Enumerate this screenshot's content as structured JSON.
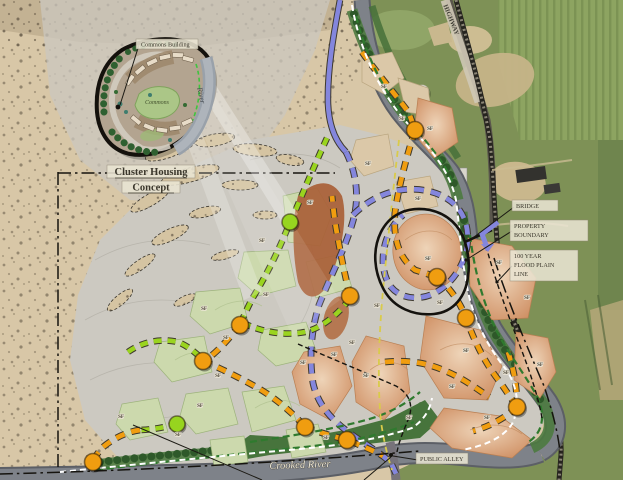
{
  "map": {
    "labels": {
      "highway": "HIGHWAY",
      "crooked_river": "Crooked River",
      "bridge": "BRIDGE",
      "property_boundary_1": "PROPERTY",
      "property_boundary_2": "BOUNDARY",
      "flood_plain_1": "100 YEAR",
      "flood_plain_2": "FLOOD PLAIN",
      "flood_plain_3": "LINE",
      "public_alley": "PUBLIC ALLEY",
      "lot": "SF"
    },
    "inset": {
      "title_line1": "Cluster Housing",
      "title_line2": "Concept",
      "commons_building": "Commons Building",
      "commons": "Commons",
      "river": "River"
    },
    "colors": {
      "orange_node": "#f09d10",
      "lime_node": "#97d41f",
      "purple_road": "#8486dd",
      "orange_road": "#f09d10",
      "lime_road": "#9ad41f",
      "green_trail": "#2f7a2e",
      "yellow_line": "#d9cb4a",
      "river_water": "#7e8289",
      "riparian_green": "#4d7a40",
      "desert_tan": "#d8c7a7",
      "floodplain_gray": "#ccc9c1",
      "lot_green": "#ccd9ad",
      "lot_salmon": "#d89a6f",
      "aerial_field_green": "#7e9156"
    },
    "nodes": {
      "orange": [
        [
          415,
          130
        ],
        [
          350,
          296
        ],
        [
          240,
          325
        ],
        [
          203,
          361
        ],
        [
          93,
          462
        ],
        [
          305,
          427
        ],
        [
          347,
          440
        ],
        [
          437,
          277
        ],
        [
          466,
          318
        ],
        [
          517,
          407
        ]
      ],
      "lime": [
        [
          290,
          222
        ],
        [
          177,
          424
        ]
      ]
    },
    "sf_positions": [
      [
        402,
        120
      ],
      [
        368,
        165
      ],
      [
        418,
        200
      ],
      [
        310,
        204
      ],
      [
        262,
        242
      ],
      [
        266,
        296
      ],
      [
        204,
        310
      ],
      [
        226,
        339
      ],
      [
        218,
        377
      ],
      [
        200,
        407
      ],
      [
        121,
        418
      ],
      [
        178,
        436
      ],
      [
        428,
        260
      ],
      [
        377,
        307
      ],
      [
        440,
        304
      ],
      [
        352,
        344
      ],
      [
        334,
        356
      ],
      [
        303,
        364
      ],
      [
        366,
        377
      ],
      [
        409,
        419
      ],
      [
        326,
        439
      ],
      [
        506,
        374
      ],
      [
        540,
        366
      ],
      [
        499,
        264
      ],
      [
        527,
        299
      ],
      [
        466,
        352
      ],
      [
        487,
        419
      ],
      [
        452,
        388
      ],
      [
        384,
        88
      ],
      [
        430,
        130
      ]
    ],
    "roads": [
      {
        "name": "riparian-band-upper-west",
        "kind": "greenband",
        "d": "M352,10 C366,56 386,94 412,124 C436,150 452,172 458,200"
      },
      {
        "name": "riparian-band-east",
        "kind": "greenband",
        "d": "M462,212 C466,252 474,292 490,326 C506,356 528,380 544,404 C554,424 550,440 532,448"
      },
      {
        "name": "riparian-band-bottom",
        "kind": "greenband",
        "d": "M95,465 C170,456 240,450 300,445 C345,441 385,432 418,416"
      },
      {
        "name": "riparian-band-upper-east",
        "kind": "greenband2",
        "d": "M372,6 C384,46 400,82 424,112 C438,130 450,144 458,158"
      },
      {
        "name": "tree-row-upper",
        "kind": "treerow",
        "d": "M354,14 C368,58 388,95 414,126 C436,150 450,168 456,190"
      },
      {
        "name": "tree-row-east",
        "kind": "treerow",
        "d": "M464,220 C468,256 476,294 492,328 C508,358 528,380 542,402"
      },
      {
        "name": "tree-row-bottom",
        "kind": "treerow",
        "d": "M100,462 C170,454 240,448 298,443 C342,439 382,430 414,414"
      },
      {
        "name": "tree-row-bottom-2",
        "kind": "treerow",
        "d": "M232,458 C270,448 310,442 352,434 C380,428 404,420 424,404"
      },
      {
        "name": "collector-road-north",
        "kind": "purple-solid",
        "casing": true,
        "d": "M340,0 C334,32 327,70 328,104 C329,126 336,142 346,152"
      },
      {
        "name": "collector-road-main",
        "kind": "purple",
        "casing": true,
        "d": "M346,152 C356,172 360,196 353,221 C345,249 330,277 319,305 C311,331 309,357 313,383 C318,406 333,421 351,434 C366,445 381,453 391,463 L397,476"
      },
      {
        "name": "collector-road-loop",
        "kind": "purple",
        "casing": true,
        "d": "M353,215 C365,203 381,193 401,190 C423,187 445,193 458,208 C467,220 469,233 467,247 C464,265 453,283 435,293 C419,301 401,299 391,287 C382,275 381,257 386,241 C390,229 396,221 403,215"
      },
      {
        "name": "local-road-north",
        "kind": "orange",
        "casing": true,
        "d": "M362,52 C376,72 396,95 409,113 L415,130 C405,162 399,186 395,212 C393,240 399,258 415,270 L437,277"
      },
      {
        "name": "local-road-east",
        "kind": "orange",
        "casing": true,
        "d": "M437,277 C450,288 460,302 466,318 C474,340 484,362 500,382 L517,407"
      },
      {
        "name": "local-road-east-spur",
        "kind": "orange",
        "casing": true,
        "d": "M517,407 C504,419 488,427 473,431"
      },
      {
        "name": "local-road-east-north-spur",
        "kind": "orange",
        "casing": true,
        "d": "M508,352 C514,370 517,388 517,405"
      },
      {
        "name": "local-road-center-north",
        "kind": "orange",
        "casing": true,
        "d": "M350,296 C344,272 340,250 336,228 C334,216 333,206 332,196"
      },
      {
        "name": "local-road-cross",
        "kind": "orange",
        "casing": true,
        "d": "M385,362 C405,360 425,362 443,370 C461,377 476,388 489,397"
      },
      {
        "name": "local-road-southwest",
        "kind": "orange",
        "casing": true,
        "d": "M203,361 C220,368 240,378 258,388 C275,398 292,412 305,427"
      },
      {
        "name": "local-road-south",
        "kind": "orange",
        "casing": true,
        "d": "M305,427 C318,432 332,436 347,440 C360,445 372,450 383,456"
      },
      {
        "name": "local-road-west-link",
        "kind": "orange",
        "casing": true,
        "d": "M240,325 C231,336 221,348 211,356 L203,361"
      },
      {
        "name": "local-road-west-tail",
        "kind": "orange",
        "casing": true,
        "d": "M140,430 C125,432 111,440 102,448 C97,454 94,458 93,462"
      },
      {
        "name": "lane-north",
        "kind": "lime",
        "casing": true,
        "d": "M327,138 C316,162 304,190 294,214 L290,222 C280,248 268,272 255,294 C249,304 245,314 241,322"
      },
      {
        "name": "lane-west-arc",
        "kind": "lime",
        "casing": true,
        "d": "M128,352 C142,342 160,338 178,342 C188,346 196,353 202,359"
      },
      {
        "name": "lane-west",
        "kind": "lime",
        "casing": true,
        "d": "M177,424 C162,428 149,430 138,430"
      },
      {
        "name": "lane-center",
        "kind": "lime",
        "casing": true,
        "d": "M243,323 C262,332 284,336 305,332 C322,328 338,314 348,301"
      },
      {
        "name": "greenway-river-west",
        "kind": "green",
        "d": "M356,16 C366,56 384,92 408,120 C430,146 446,164 452,182"
      },
      {
        "name": "greenway-east",
        "kind": "green",
        "d": "M470,235 C474,268 482,300 496,330 C510,356 526,376 538,398 C546,418 542,434 527,443"
      },
      {
        "name": "greenway-bottom",
        "kind": "green",
        "d": "M96,470 C160,462 230,455 294,448 C340,444 380,436 414,422"
      },
      {
        "name": "greenway-bottom-inner",
        "kind": "green",
        "d": "M250,442 C290,436 330,430 366,420 C388,414 406,404 420,392"
      },
      {
        "name": "flood-plain-line-east",
        "kind": "blackdash",
        "d": "M486,246 C494,276 506,310 520,346 C530,372 538,396 542,418"
      },
      {
        "name": "flood-plain-line-center",
        "kind": "blackdash",
        "d": "M298,344 C330,358 364,372 396,386 C410,394 414,406 408,420 C404,430 399,441 397,452"
      },
      {
        "name": "utility-line",
        "kind": "yellow",
        "d": "M399,140 C393,190 388,240 383,290 C379,335 377,380 381,422 C384,442 388,458 392,470"
      },
      {
        "name": "river-trail-west",
        "kind": "white",
        "d": "M352,5 C360,52 380,92 408,124 C432,150 450,172 456,200 C460,232 462,268 470,300 C477,326 490,350 508,372 C518,390 520,408 512,424 C503,438 484,446 462,450"
      },
      {
        "name": "river-trail-south",
        "kind": "white",
        "d": "M60,472 C140,464 220,456 300,449 C345,445 382,438 412,428 C424,420 430,410 432,398"
      },
      {
        "name": "section-line-west",
        "kind": "dashdot",
        "d": "M58,172 L58,468"
      },
      {
        "name": "section-line-north",
        "kind": "dashdot",
        "d": "M58,173 L335,173"
      },
      {
        "name": "section-line-river",
        "kind": "dashdot",
        "d": "M0,474 C120,471 250,465 420,451"
      },
      {
        "name": "section-line-railroad",
        "kind": "dashdot",
        "d": "M494,258 C506,296 524,340 544,386 C552,410 558,432 560,452"
      }
    ]
  }
}
